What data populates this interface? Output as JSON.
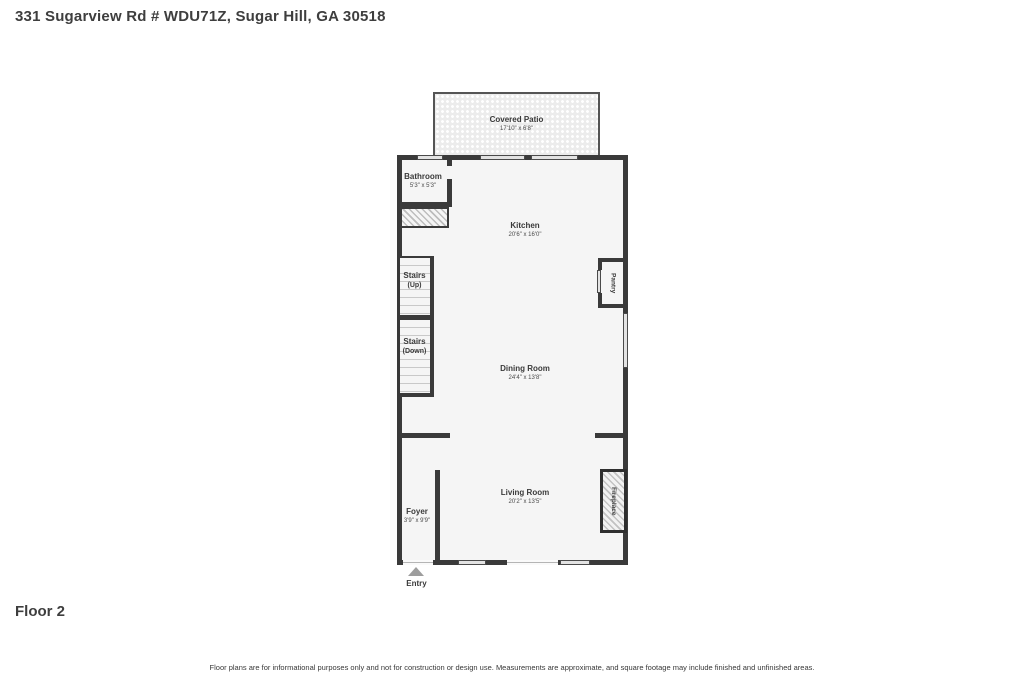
{
  "header": {
    "title": "331 Sugarview Rd # WDU71Z, Sugar Hill, GA 30518"
  },
  "footer": {
    "floor_label": "Floor 2",
    "disclaimer": "Floor plans are for informational purposes only and not for construction or design use. Measurements are approximate, and square footage may include finished and unfinished areas."
  },
  "floorplan": {
    "entry_label": "Entry",
    "rooms": {
      "covered_patio": {
        "label": "Covered Patio",
        "dims": "17'10\" x 6'8\""
      },
      "bathroom": {
        "label": "Bathroom",
        "dims": "5'3\" x 5'3\""
      },
      "kitchen": {
        "label": "Kitchen",
        "dims": "20'6\" x 16'0\""
      },
      "stairs_up": {
        "label": "Stairs",
        "dims": "(Up)"
      },
      "stairs_down": {
        "label": "Stairs",
        "dims": "(Down)"
      },
      "pantry": {
        "label": "Pantry"
      },
      "dining_room": {
        "label": "Dining Room",
        "dims": "24'4\" x 13'8\""
      },
      "living_room": {
        "label": "Living Room",
        "dims": "20'2\" x 13'5\""
      },
      "foyer": {
        "label": "Foyer",
        "dims": "3'9\" x 9'9\""
      },
      "fireplace": {
        "label": "Fireplace"
      }
    },
    "colors": {
      "wall": "#3a3a3a",
      "room_fill": "#f5f5f5",
      "window_fill": "#e3e3e3",
      "patio_fill": "#ececec",
      "text": "#3d3d3d",
      "entry_arrow": "#9d9d9d"
    }
  }
}
